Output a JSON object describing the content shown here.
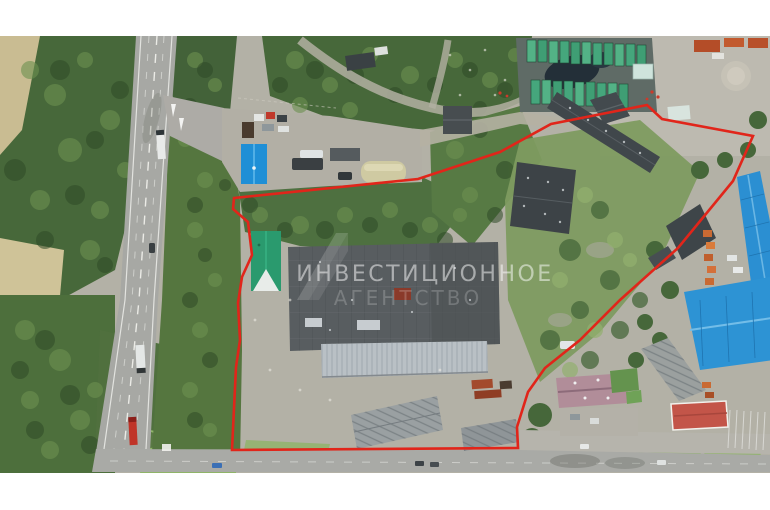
{
  "page": {
    "type": "aerial drone photo of industrial land plot for sale",
    "letterbox_color": "#ffffff",
    "orientation": "top-down"
  },
  "watermark": {
    "line1": "ИНВЕСТИЦИОННОЕ",
    "line2": "АГЕНТСТВО",
    "color": "#ffffff",
    "style": "semi-transparent overlay with geometric logo"
  },
  "boundary": {
    "label": "red outline of the property being sold",
    "color": "#e1251a",
    "shape": "irregular closed polygon around industrial yard with warehouses"
  },
  "features": {
    "highway": {
      "label": "divided highway on the left",
      "color": "#a7a8a4",
      "markings": "#e9e9e5"
    },
    "bottom_road": {
      "label": "street along bottom edge",
      "color": "#a9aaa6"
    },
    "side_road": {
      "label": "access road from highway into the yard",
      "color": "#b2afa5"
    },
    "main_warehouse": {
      "label": "large dark-roof production warehouse",
      "color": "#585d60",
      "patch_color": "#8a3a2a"
    },
    "warehouse_annex": {
      "label": "light corrugated lean-to roof",
      "color": "#b9c0c5"
    },
    "green_roof_house": {
      "label": "small house with teal-green gabled roof",
      "color": "#2a9a6e"
    },
    "blue_roof_house": {
      "label": "small house with bright blue gabled roof near entrance",
      "color": "#1f8fd6"
    },
    "quonset_hut": {
      "label": "beige rounded hangar",
      "color": "#cfcaa2"
    },
    "green_containers": {
      "label": "two rows of green containers on dark pad, top right",
      "color": "#4aa87c"
    },
    "blue_warehouse_north": {
      "label": "long blue warehouse, right edge",
      "color": "#2b8fd2"
    },
    "blue_warehouse_south": {
      "label": "wide blue warehouse, lower right",
      "color": "#2d93d4"
    },
    "gray_warehouse_right": {
      "label": "gray ridged warehouse, lower right",
      "color": "#9ba09f"
    },
    "purple_building": {
      "label": "mauve/pink gabled building, bottom",
      "color": "#b18d99"
    },
    "salmon_building": {
      "label": "red hip-roof kiosk with white trim, bottom right",
      "color": "#c35549"
    },
    "gray_sheds": {
      "label": "old gray gabled sheds inside plot, bottom",
      "color": "#9aa0a2"
    },
    "orange_trucks": {
      "label": "row of orange trucks parked along blue warehouse",
      "color": "#c96a33"
    },
    "forest": {
      "label": "dense green woodland",
      "color": "#47683a"
    },
    "field": {
      "label": "tan dry field left of highway",
      "color": "#cfc398"
    },
    "vehicles_on_highway": {
      "label": "white trucks and red truck driving on highway"
    }
  }
}
